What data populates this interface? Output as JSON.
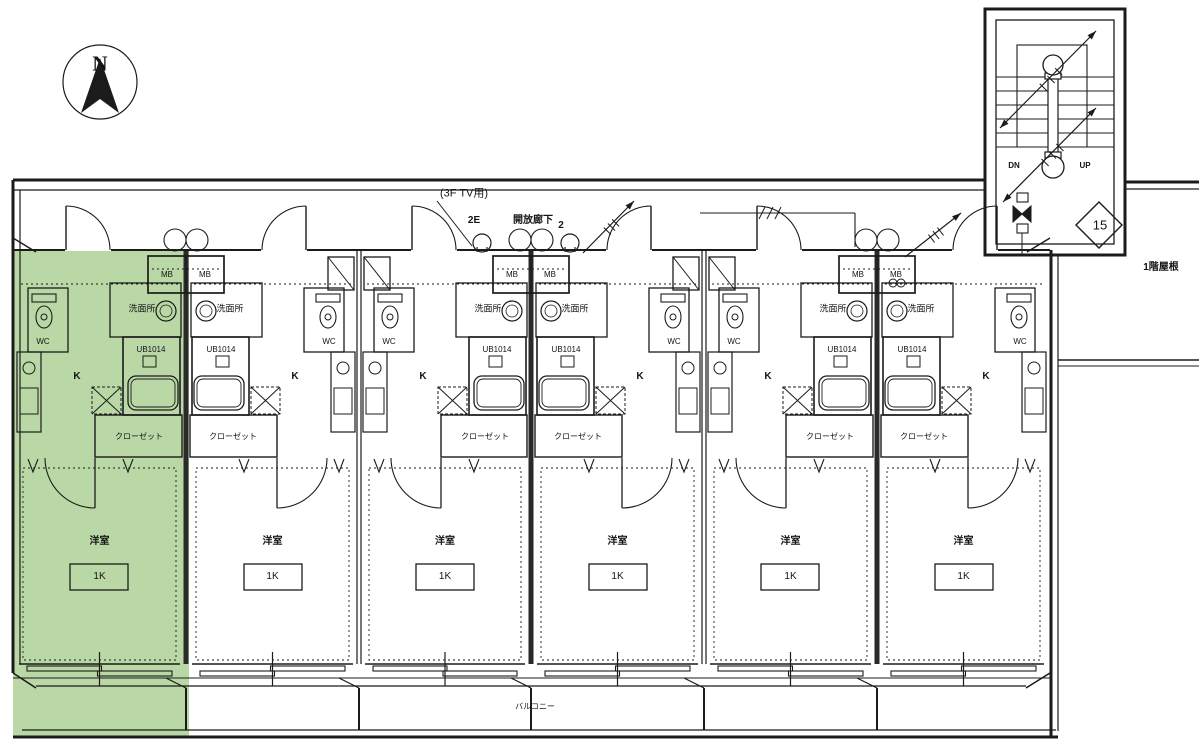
{
  "drawing": {
    "north_label": "N",
    "stairwell": {
      "down_label": "DN",
      "up_label": "UP",
      "room_number": "15"
    },
    "corridor": {
      "tv_note": "(3F TV用)",
      "name": "開放廊下",
      "light_left": "2E",
      "light_right": "2"
    },
    "annotations": {
      "roof": "1階屋根",
      "balcony": "バルコニー"
    },
    "unit_labels": {
      "washroom": "洗面所",
      "bath_model": "UB1014",
      "toilet": "WC",
      "kitchen": "K",
      "closet": "クローゼット",
      "main_room": "洋室",
      "plan_type": "1K",
      "meter_box": "MB"
    },
    "units": [
      {
        "id": "unit-1",
        "plan": "1K",
        "highlighted": true
      },
      {
        "id": "unit-2",
        "plan": "1K",
        "highlighted": false
      },
      {
        "id": "unit-3",
        "plan": "1K",
        "highlighted": false
      },
      {
        "id": "unit-4",
        "plan": "1K",
        "highlighted": false
      },
      {
        "id": "unit-5",
        "plan": "1K",
        "highlighted": false
      },
      {
        "id": "unit-6",
        "plan": "1K",
        "highlighted": false
      }
    ],
    "colors": {
      "highlight": "#b9d8a6",
      "line": "#1b1b1b",
      "background": "#ffffff"
    }
  }
}
